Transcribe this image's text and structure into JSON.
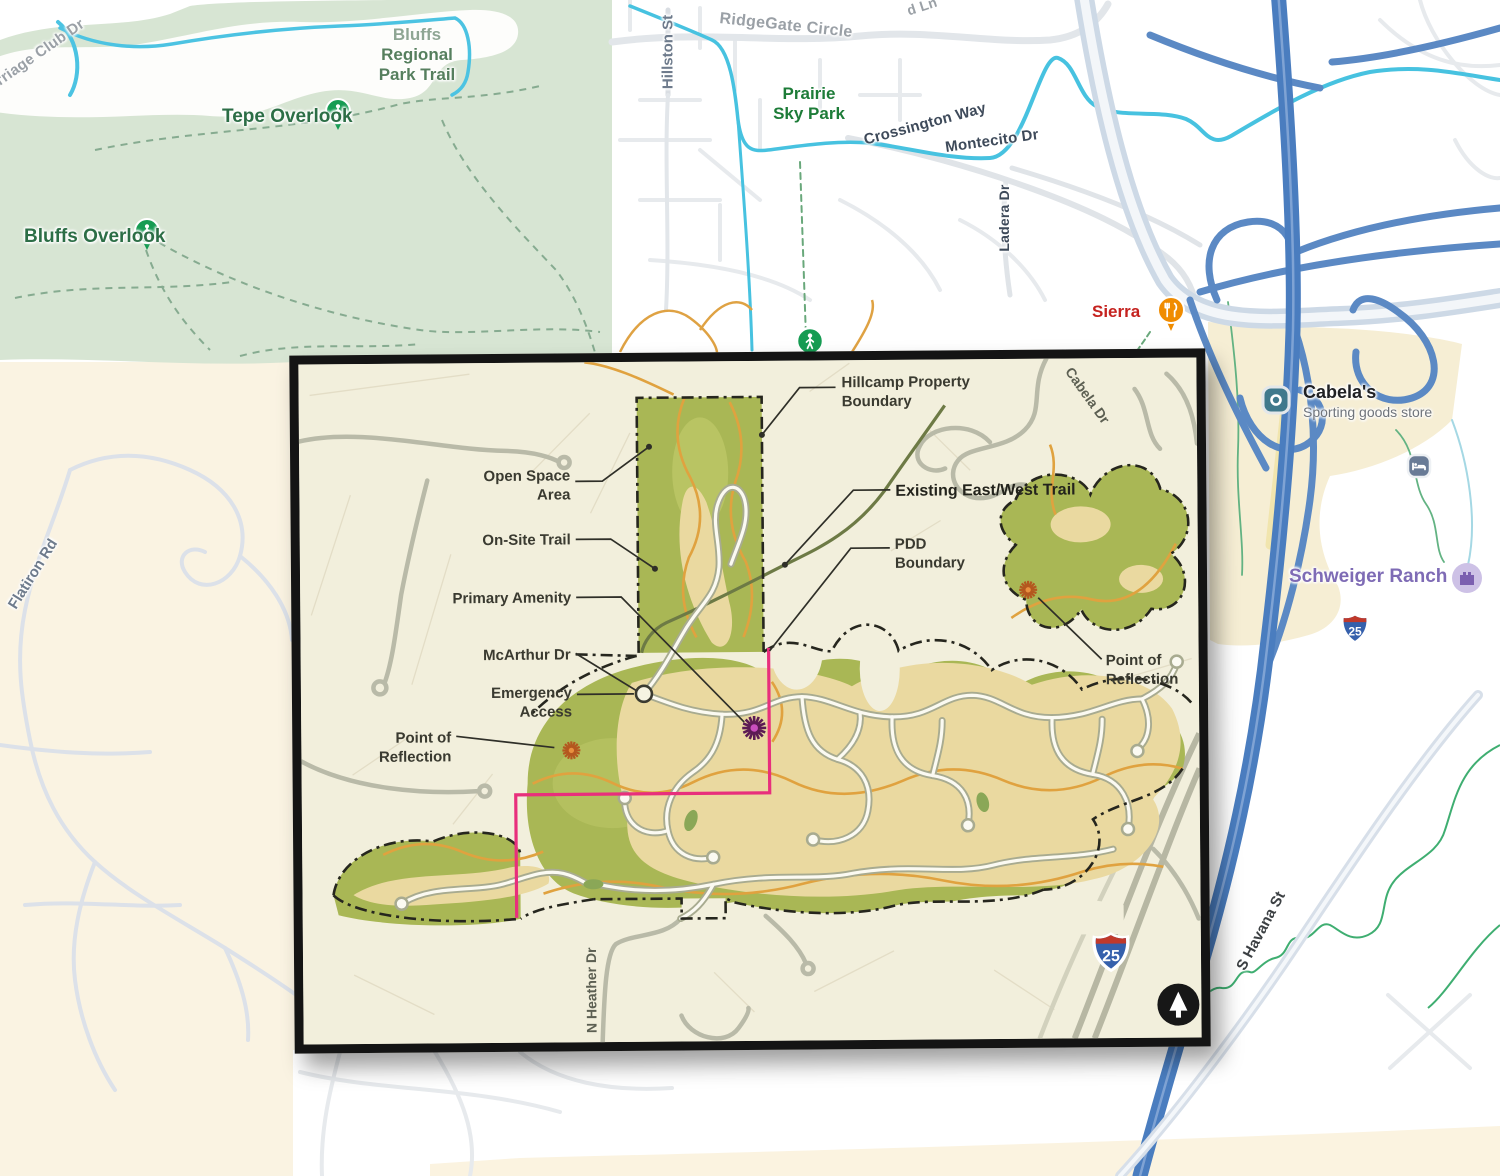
{
  "colors": {
    "park_green": "#d7e5d3",
    "cream_land": "#faf3e2",
    "commercial_beige": "#f6eed4",
    "highway_blue": "#4a7dbf",
    "arterial_light": "#cdd9e6",
    "creek_cyan": "#47c2e0",
    "trail_green_dashed": "#86ab90",
    "boundary_green": "#3fae71",
    "inset_bg": "#f2efdc",
    "open_space_olive": "#a9b755",
    "golf_tan": "#ead9a0",
    "trail_orange": "#e0a23f",
    "pdd_magenta": "#e82f7c",
    "property_boundary_black": "#26261e",
    "pin_green": "#169c53",
    "pin_orange": "#f08c00",
    "shop_teal": "#40798c",
    "ranch_purple": "#7e6bb5"
  },
  "base_map": {
    "park_trail_label": {
      "line1": "Bluffs",
      "line2": "Regional",
      "line3": "Park Trail"
    },
    "pois": {
      "tepe_overlook": "Tepe Overlook",
      "bluffs_overlook": "Bluffs Overlook",
      "prairie_sky_park": {
        "line1": "Prairie",
        "line2": "Sky Park"
      },
      "sierra": "Sierra",
      "cabelas": {
        "name": "Cabela's",
        "subtitle": "Sporting goods store"
      },
      "schweiger_ranch": "Schweiger Ranch"
    },
    "streets": {
      "carriage_club": "Carriage Club Dr",
      "ridgegate_circle": "RidgeGate Circle",
      "partial_lane": "d Ln",
      "hillston": "Hillston St",
      "crossington": "Crossington Way",
      "montecito": "Montecito Dr",
      "ladera": "Ladera Dr",
      "flatiron": "Flatiron Rd",
      "havana": "S Havana St"
    },
    "interstate_shield": "25"
  },
  "inset": {
    "callouts": {
      "hillcamp": {
        "line1": "Hillcamp Property",
        "line2": "Boundary"
      },
      "open_space": {
        "line1": "Open Space",
        "line2": "Area"
      },
      "onsite_trail": "On-Site Trail",
      "primary_amenity": "Primary Amenity",
      "mcarthur": "McArthur Dr",
      "emergency": {
        "line1": "Emergency",
        "line2": "Access"
      },
      "point_left": {
        "line1": "Point of",
        "line2": "Reflection"
      },
      "existing_trail": "Existing East/West Trail",
      "pdd": {
        "line1": "PDD",
        "line2": "Boundary"
      },
      "point_right": {
        "line1": "Point of",
        "line2": "Reflection"
      }
    },
    "streets": {
      "cabela_dr": "Cabela Dr",
      "heather": "N Heather Dr"
    },
    "interstate_shield": "25"
  }
}
